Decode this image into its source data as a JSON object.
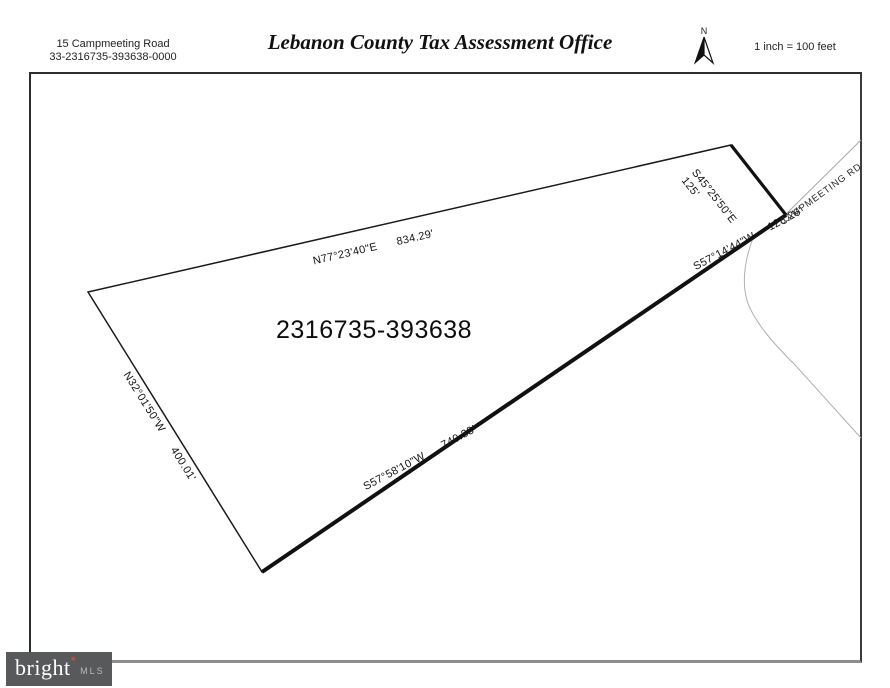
{
  "header": {
    "address_line1": "15 Campmeeting Road",
    "address_line2": "33-2316735-393638-0000",
    "title": "Lebanon County Tax Assessment Office",
    "north_label": "N",
    "scale": "1 inch = 100 feet"
  },
  "parcel": {
    "number": "2316735-393638",
    "road_label": "CAMPMEETING RD",
    "edges": [
      {
        "side": "north",
        "bearing": "N77°23'40\"E",
        "distance": "834.29'"
      },
      {
        "side": "northeast",
        "bearing": "S45°25'50\"E",
        "distance": "125'"
      },
      {
        "side": "east",
        "bearing": "S57°14'44\"W",
        "distance": "128.26'"
      },
      {
        "side": "southeast",
        "bearing": "S57°58'10\"W",
        "distance": "740.33'"
      },
      {
        "side": "west",
        "bearing": "N32°01'50\"W",
        "distance": "400.01'"
      }
    ]
  },
  "footer": {
    "logo": {
      "word": "bright",
      "star": "✶",
      "suffix": "MLS"
    }
  },
  "colors": {
    "logo_background": "#58595b",
    "logo_star": "#cf4f35",
    "boundary": "#1a1a1a",
    "road_line": "#aaaaaa"
  }
}
